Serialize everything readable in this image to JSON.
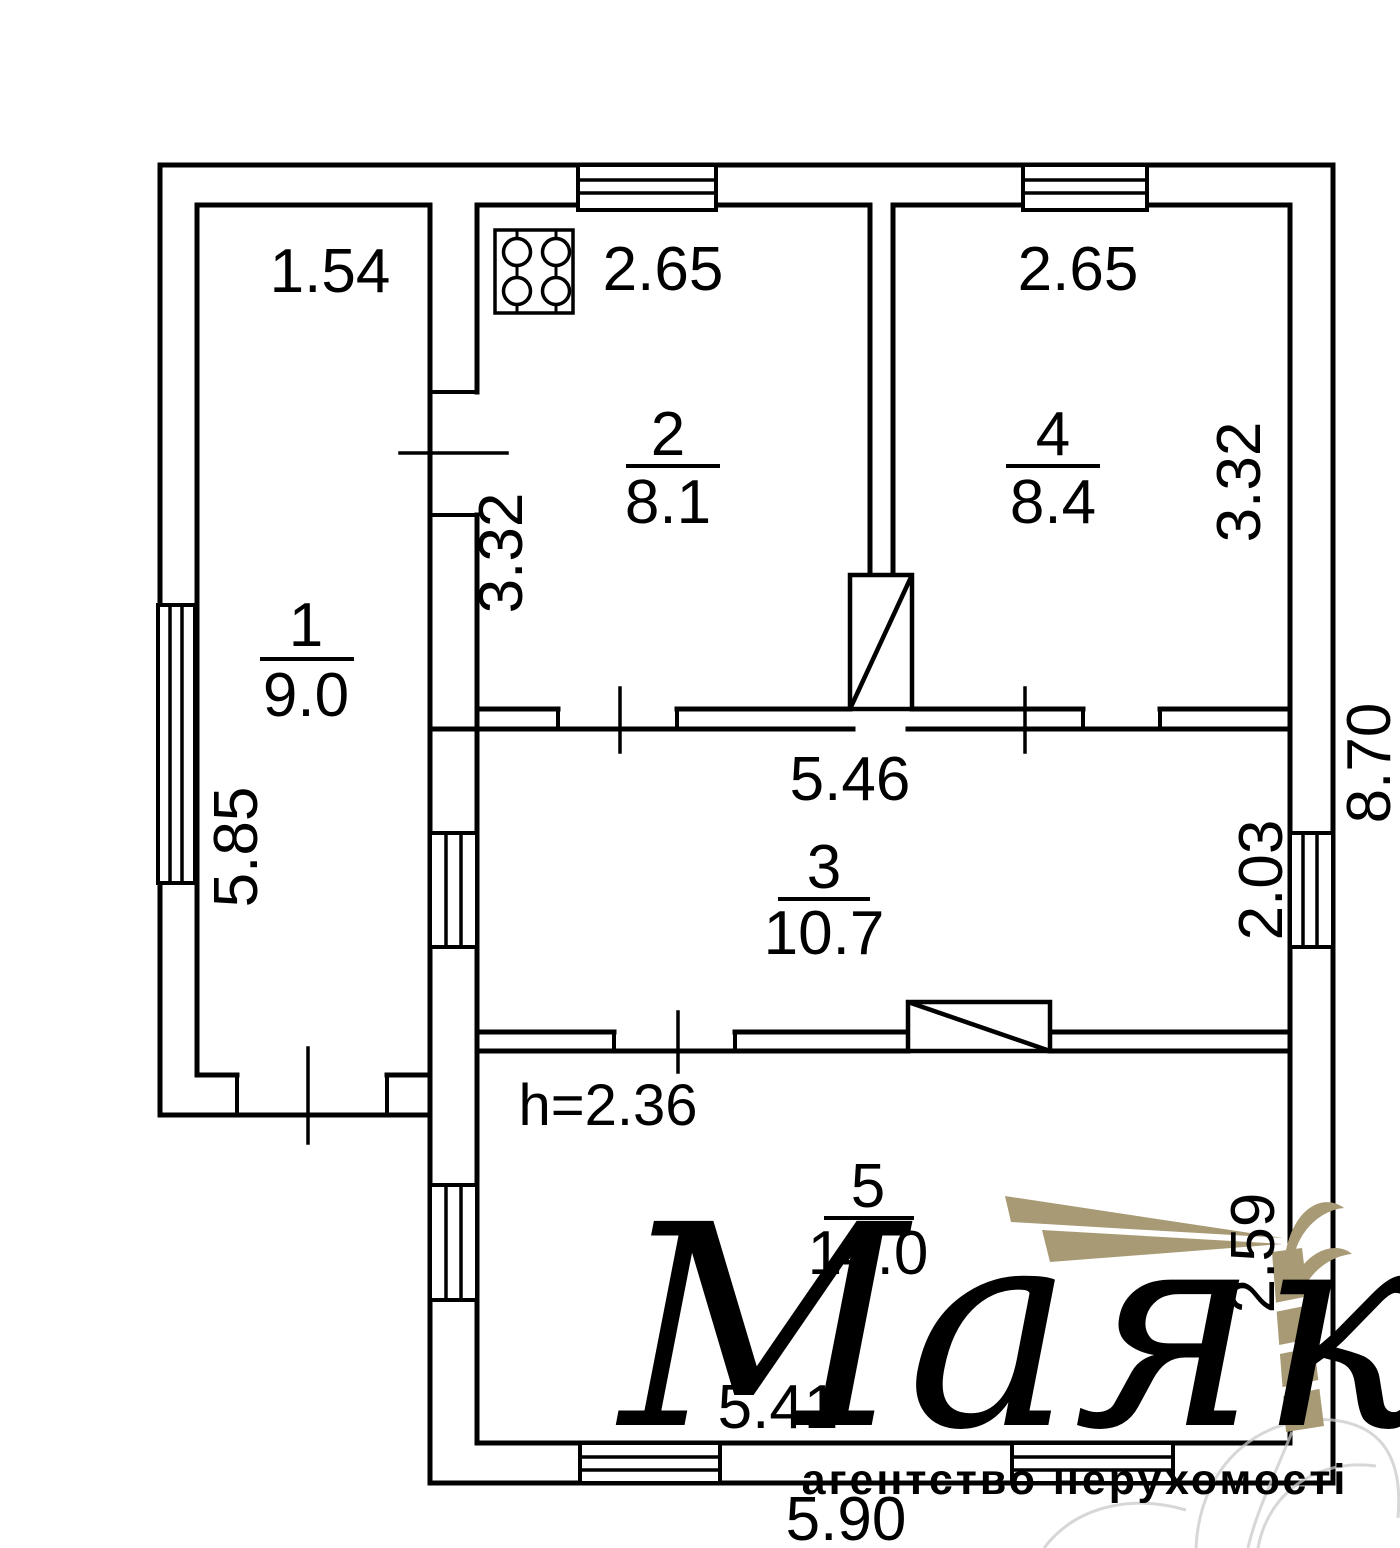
{
  "plan": {
    "height_note": "h=2.36",
    "rooms": [
      {
        "number": "1",
        "area": "9.0"
      },
      {
        "number": "2",
        "area": "8.1"
      },
      {
        "number": "3",
        "area": "10.7"
      },
      {
        "number": "4",
        "area": "8.4"
      },
      {
        "number": "5",
        "area": "14.0"
      }
    ],
    "dimensions": {
      "room1_width": "1.54",
      "room1_depth": "5.85",
      "room2_width": "2.65",
      "room2_depth": "3.32",
      "room4_width": "2.65",
      "room4_depth": "3.32",
      "room3_width": "5.46",
      "room3_depth": "2.03",
      "right_side_total": "8.70",
      "room5_width": "5.41",
      "room5_depth": "2.59",
      "bottom_total": "5.90"
    },
    "icons": {
      "stove": "stove-icon",
      "windows": "window-icon",
      "doors": "door-icon"
    }
  },
  "watermark": {
    "brand": "Маяк",
    "tagline": "агентство нерухомості",
    "color": "#a89a74",
    "sketch_color": "#c9c9c9"
  },
  "colors": {
    "line": "#000000",
    "background": "#ffffff"
  }
}
